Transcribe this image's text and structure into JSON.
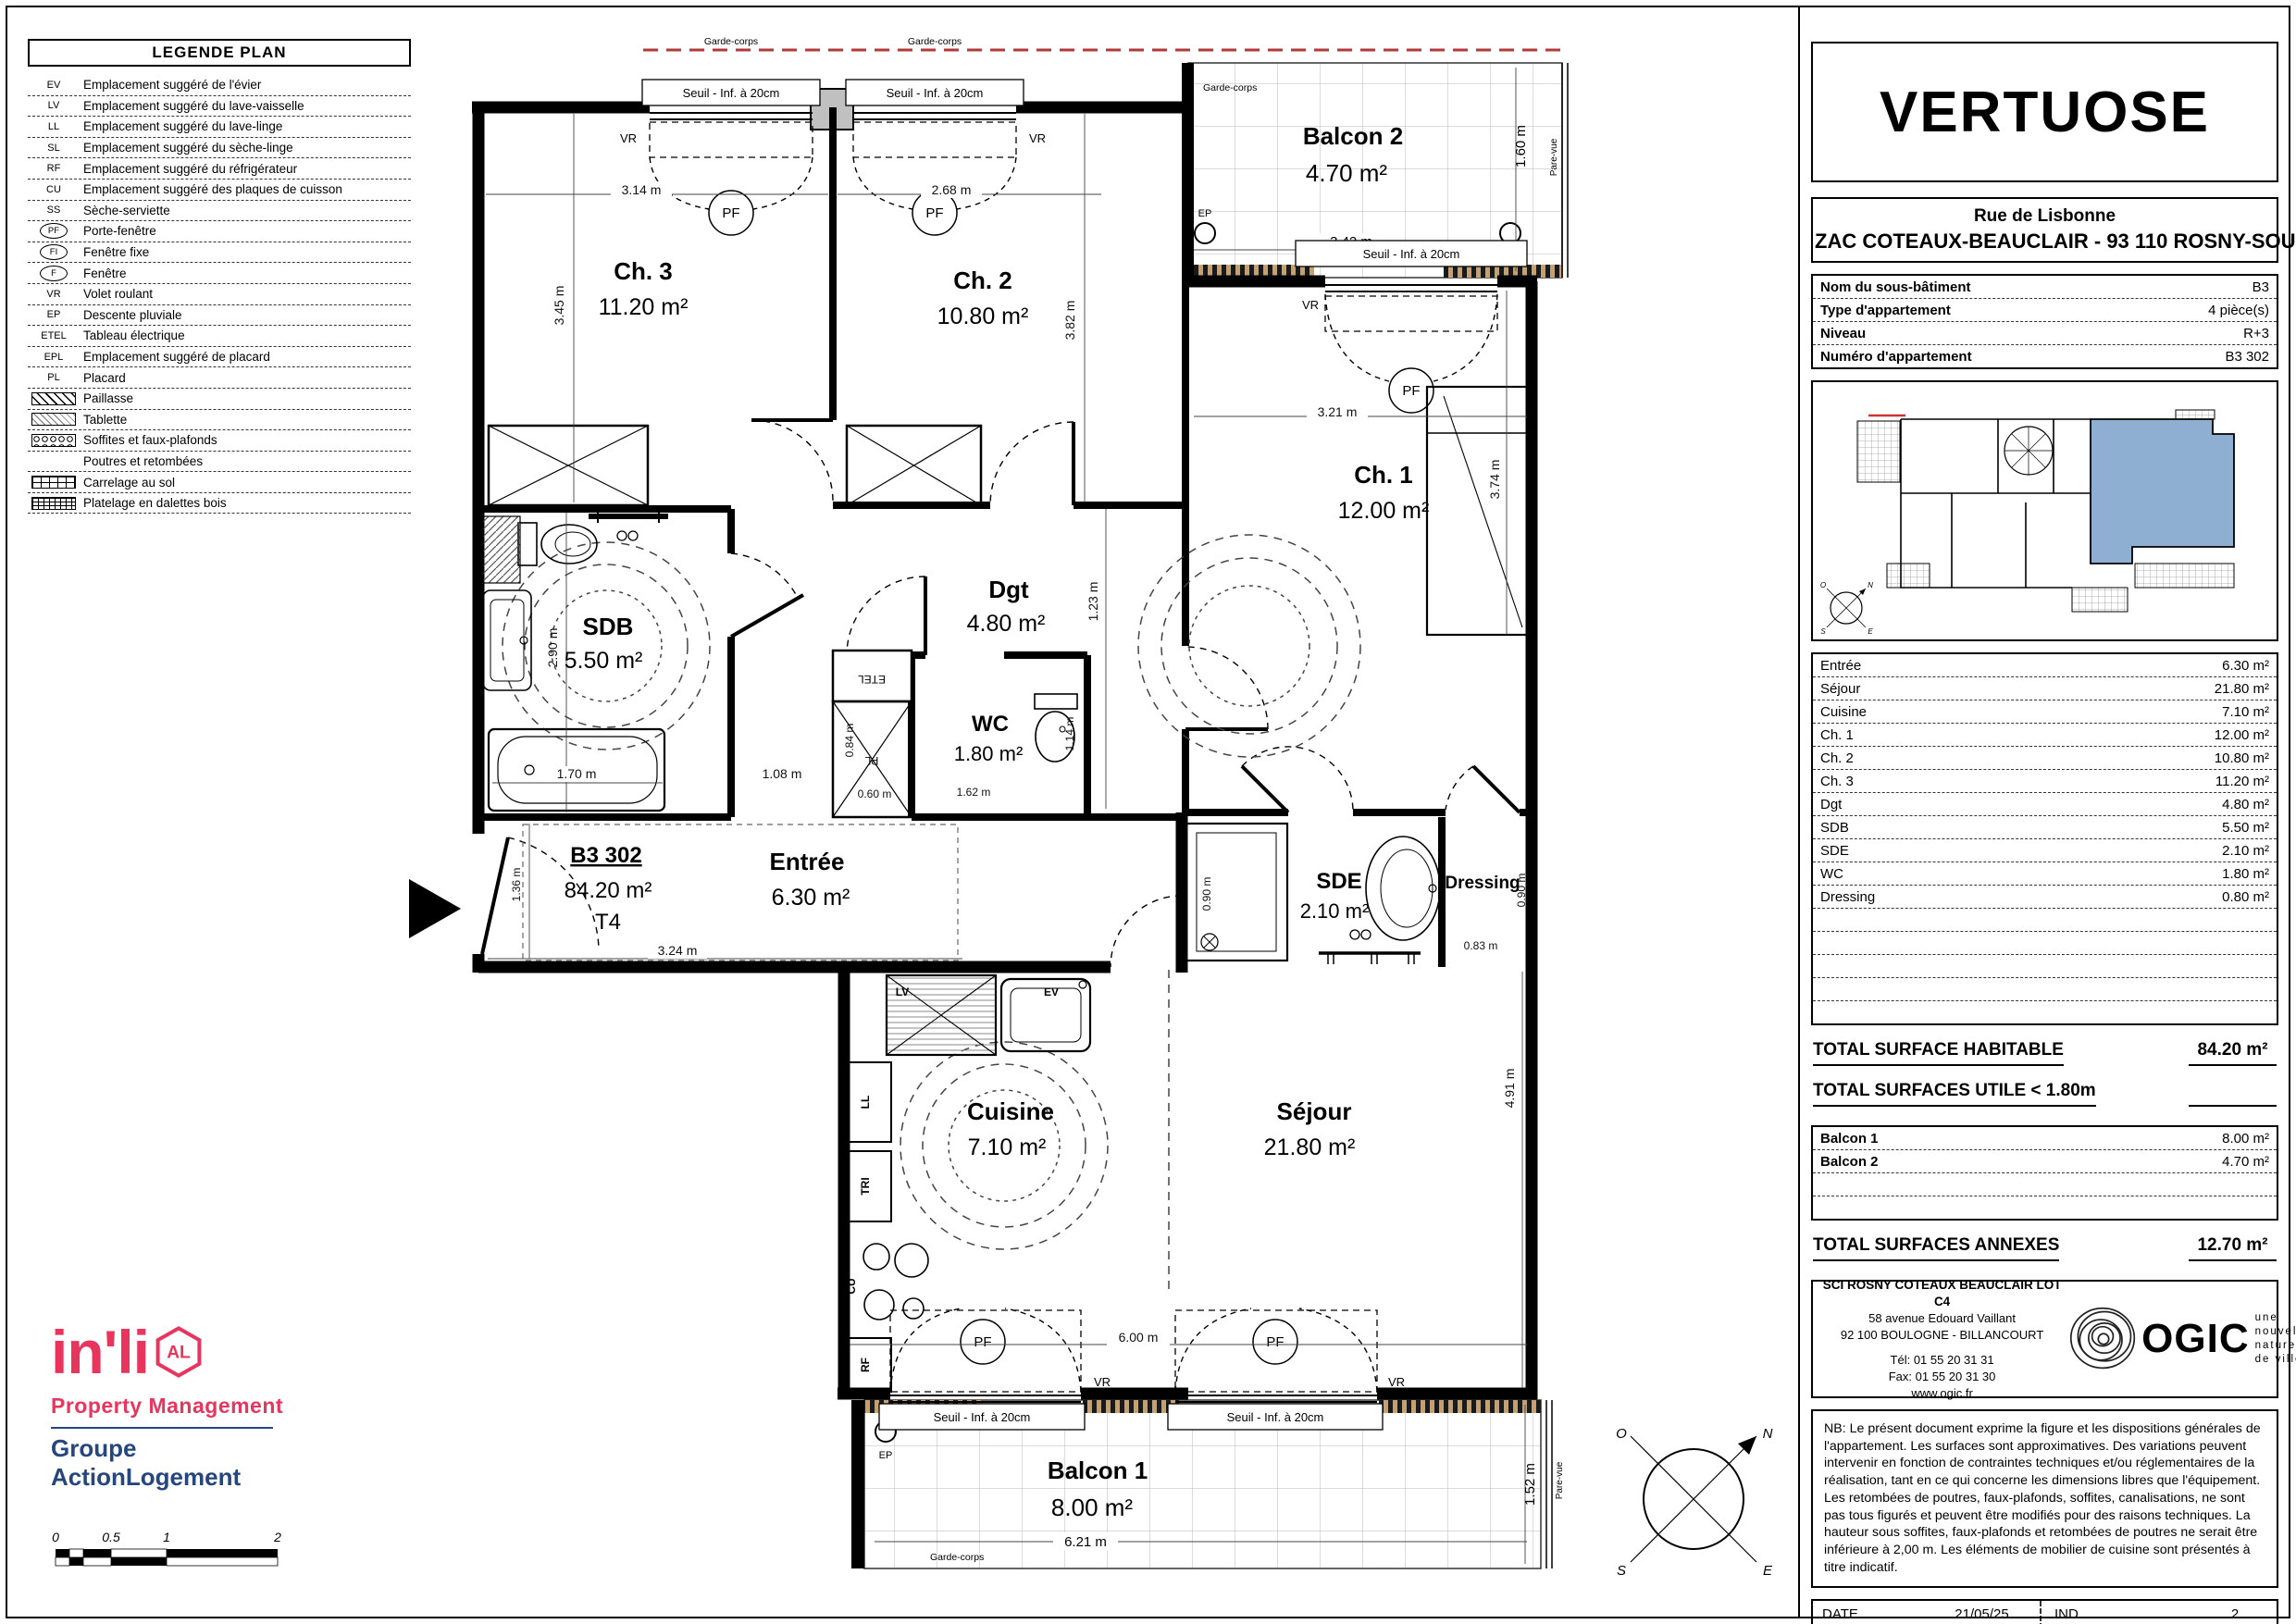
{
  "legend": {
    "title": "LEGENDE PLAN",
    "items": [
      {
        "key": "EV",
        "label": "Emplacement suggéré de l'évier",
        "style": "text"
      },
      {
        "key": "LV",
        "label": "Emplacement suggéré du lave-vaisselle",
        "style": "text"
      },
      {
        "key": "LL",
        "label": "Emplacement suggéré du lave-linge",
        "style": "text"
      },
      {
        "key": "SL",
        "label": "Emplacement suggéré du sèche-linge",
        "style": "text"
      },
      {
        "key": "RF",
        "label": "Emplacement suggéré du réfrigérateur",
        "style": "text"
      },
      {
        "key": "CU",
        "label": "Emplacement suggéré des plaques de cuisson",
        "style": "text"
      },
      {
        "key": "SS",
        "label": "Sèche-serviette",
        "style": "text"
      },
      {
        "key": "PF",
        "label": "Porte-fenêtre",
        "style": "circle"
      },
      {
        "key": "FI",
        "label": "Fenêtre fixe",
        "style": "circle"
      },
      {
        "key": "F",
        "label": "Fenêtre",
        "style": "circle"
      },
      {
        "key": "VR",
        "label": "Volet roulant",
        "style": "text"
      },
      {
        "key": "EP",
        "label": "Descente pluviale",
        "style": "text"
      },
      {
        "key": "ETEL",
        "label": "Tableau électrique",
        "style": "text"
      },
      {
        "key": "EPL",
        "label": "Emplacement suggéré de placard",
        "style": "text"
      },
      {
        "key": "PL",
        "label": "Placard",
        "style": "text"
      },
      {
        "key": "",
        "label": "Paillasse",
        "style": "sw-diag"
      },
      {
        "key": "",
        "label": "Tablette",
        "style": "sw-diag2"
      },
      {
        "key": "",
        "label": "Soffites et faux-plafonds",
        "style": "sw-circles"
      },
      {
        "key": "",
        "label": "Poutres et retombées",
        "style": "sw-none"
      },
      {
        "key": "",
        "label": "Carrelage au sol",
        "style": "sw-grid"
      },
      {
        "key": "",
        "label": "Platelage en dalettes bois",
        "style": "sw-gridfine"
      }
    ]
  },
  "project": {
    "name": "VERTUOSE",
    "address_line1": "Rue de Lisbonne",
    "address_line2": "ZAC COTEAUX-BEAUCLAIR - 93 110 ROSNY-SOUS-BOIS"
  },
  "info": {
    "rows": [
      {
        "label": "Nom du sous-bâtiment",
        "value": "B3"
      },
      {
        "label": "Type d'appartement",
        "value": "4 pièce(s)"
      },
      {
        "label": "Niveau",
        "value": "R+3"
      },
      {
        "label": "Numéro d'appartement",
        "value": "B3 302"
      }
    ]
  },
  "surfaces": {
    "rows": [
      {
        "label": "Entrée",
        "value": "6.30 m²"
      },
      {
        "label": "Séjour",
        "value": "21.80 m²"
      },
      {
        "label": "Cuisine",
        "value": "7.10 m²"
      },
      {
        "label": "Ch. 1",
        "value": "12.00 m²"
      },
      {
        "label": "Ch. 2",
        "value": "10.80 m²"
      },
      {
        "label": "Ch. 3",
        "value": "11.20 m²"
      },
      {
        "label": "Dgt",
        "value": "4.80 m²"
      },
      {
        "label": "SDB",
        "value": "5.50 m²"
      },
      {
        "label": "SDE",
        "value": "2.10 m²"
      },
      {
        "label": "WC",
        "value": "1.80 m²"
      },
      {
        "label": "Dressing",
        "value": "0.80 m²"
      }
    ],
    "total_habitable_label": "TOTAL SURFACE HABITABLE",
    "total_habitable_value": "84.20 m²",
    "total_utile_label": "TOTAL SURFACES UTILE < 1.80m",
    "annex_rows": [
      {
        "label": "Balcon 1",
        "value": "8.00 m²"
      },
      {
        "label": "Balcon 2",
        "value": "4.70 m²"
      }
    ],
    "total_annexes_label": "TOTAL SURFACES ANNEXES",
    "total_annexes_value": "12.70 m²"
  },
  "company": {
    "name": "SCI ROSNY COTEAUX BEAUCLAIR LOT C4",
    "address1": "58 avenue Edouard Vaillant",
    "address2": "92 100 BOULOGNE - BILLANCOURT",
    "tel": "Tél: 01 55 20 31 31",
    "fax": "Fax: 01 55 20 31 30",
    "web": "www.ogic.fr",
    "logo": "OGIC",
    "tagline": "une\nnouvelle\nnature\nde ville"
  },
  "nb_text": "NB: Le présent document exprime la figure et les dispositions générales de l'appartement. Les surfaces sont approximatives. Des variations peuvent intervenir en fonction de contraintes techniques et/ou réglementaires de la réalisation, tant en ce qui concerne les dimensions libres que l'équipement. Les retombées de poutres, faux-plafonds, soffites, canalisations, ne sont pas tous figurés et peuvent être modifiés pour des raisons techniques. La hauteur sous soffites, faux-plafonds et retombées de poutres ne serait être inférieure à 2,00 m. Les éléments de mobilier de cuisine sont présentés à titre indicatif.",
  "footer": {
    "date_label": "DATE",
    "date_value": "21/05/25",
    "ind_label": "IND",
    "ind_value": "2"
  },
  "branding": {
    "inli": "in'li",
    "mark": "AL",
    "subtitle": "Property Management",
    "group": "Groupe ActionLogement",
    "accent": "#e8355e",
    "blue": "#26477e"
  },
  "scalebar": {
    "t0": "0",
    "t05": "0.5",
    "t1": "1",
    "t2": "2"
  },
  "plan": {
    "unit": {
      "id": "B3 302",
      "area": "84.20 m²",
      "type": "T4"
    },
    "rooms": {
      "ch3": {
        "name": "Ch. 3",
        "area": "11.20 m²"
      },
      "ch2": {
        "name": "Ch. 2",
        "area": "10.80 m²"
      },
      "ch1": {
        "name": "Ch. 1",
        "area": "12.00 m²"
      },
      "balcon2": {
        "name": "Balcon 2",
        "area": "4.70 m²"
      },
      "balcon1": {
        "name": "Balcon 1",
        "area": "8.00 m²"
      },
      "sdb": {
        "name": "SDB",
        "area": "5.50 m²"
      },
      "dgt": {
        "name": "Dgt",
        "area": "4.80 m²"
      },
      "wc": {
        "name": "WC",
        "area": "1.80 m²"
      },
      "sde": {
        "name": "SDE",
        "area": "2.10 m²"
      },
      "dressing": {
        "name": "Dressing"
      },
      "entree": {
        "name": "Entrée",
        "area": "6.30 m²"
      },
      "cuisine": {
        "name": "Cuisine",
        "area": "7.10 m²"
      },
      "sejour": {
        "name": "Séjour",
        "area": "21.80 m²"
      }
    },
    "labels": {
      "seuil": "Seuil - Inf. à 20cm",
      "garde_corps": "Garde-corps",
      "pare_vue": "Pare-vue",
      "vr": "VR",
      "pf": "PF",
      "ep": "EP",
      "etel": "ETEL",
      "pl": "PL",
      "lv": "LV",
      "ev": "EV",
      "ll": "LL",
      "tri": "TRI",
      "cu": "CU",
      "rf": "RF"
    },
    "dims": {
      "ch3_w": "3.14 m",
      "ch3_h": "3.45 m",
      "ch2_w": "2.68 m",
      "ch2_h": "3.82 m",
      "b2_w": "3.42 m",
      "b2_h": "1.60 m",
      "ch1_w": "3.21 m",
      "ch1_h": "3.74 m",
      "sdb_h": "2.90 m",
      "bath": "1.70 m",
      "corr": "1.08 m",
      "dgt_h": "1.23 m",
      "pl_h": "0.84 m",
      "pl_w": "0.60 m",
      "wc_w": "1.62 m",
      "wc_h": "1.14 m",
      "shower": "0.90 m",
      "dress_w": "0.83 m",
      "dress_h": "0.90 m",
      "ent_h": "1.36 m",
      "ent_w": "3.24 m",
      "sej_w": "6.00 m",
      "sej_h": "4.91 m",
      "b1_w": "6.21 m",
      "b1_h": "1.52 m"
    },
    "compass": {
      "n": "N",
      "s": "S",
      "e": "E",
      "o": "O"
    }
  }
}
